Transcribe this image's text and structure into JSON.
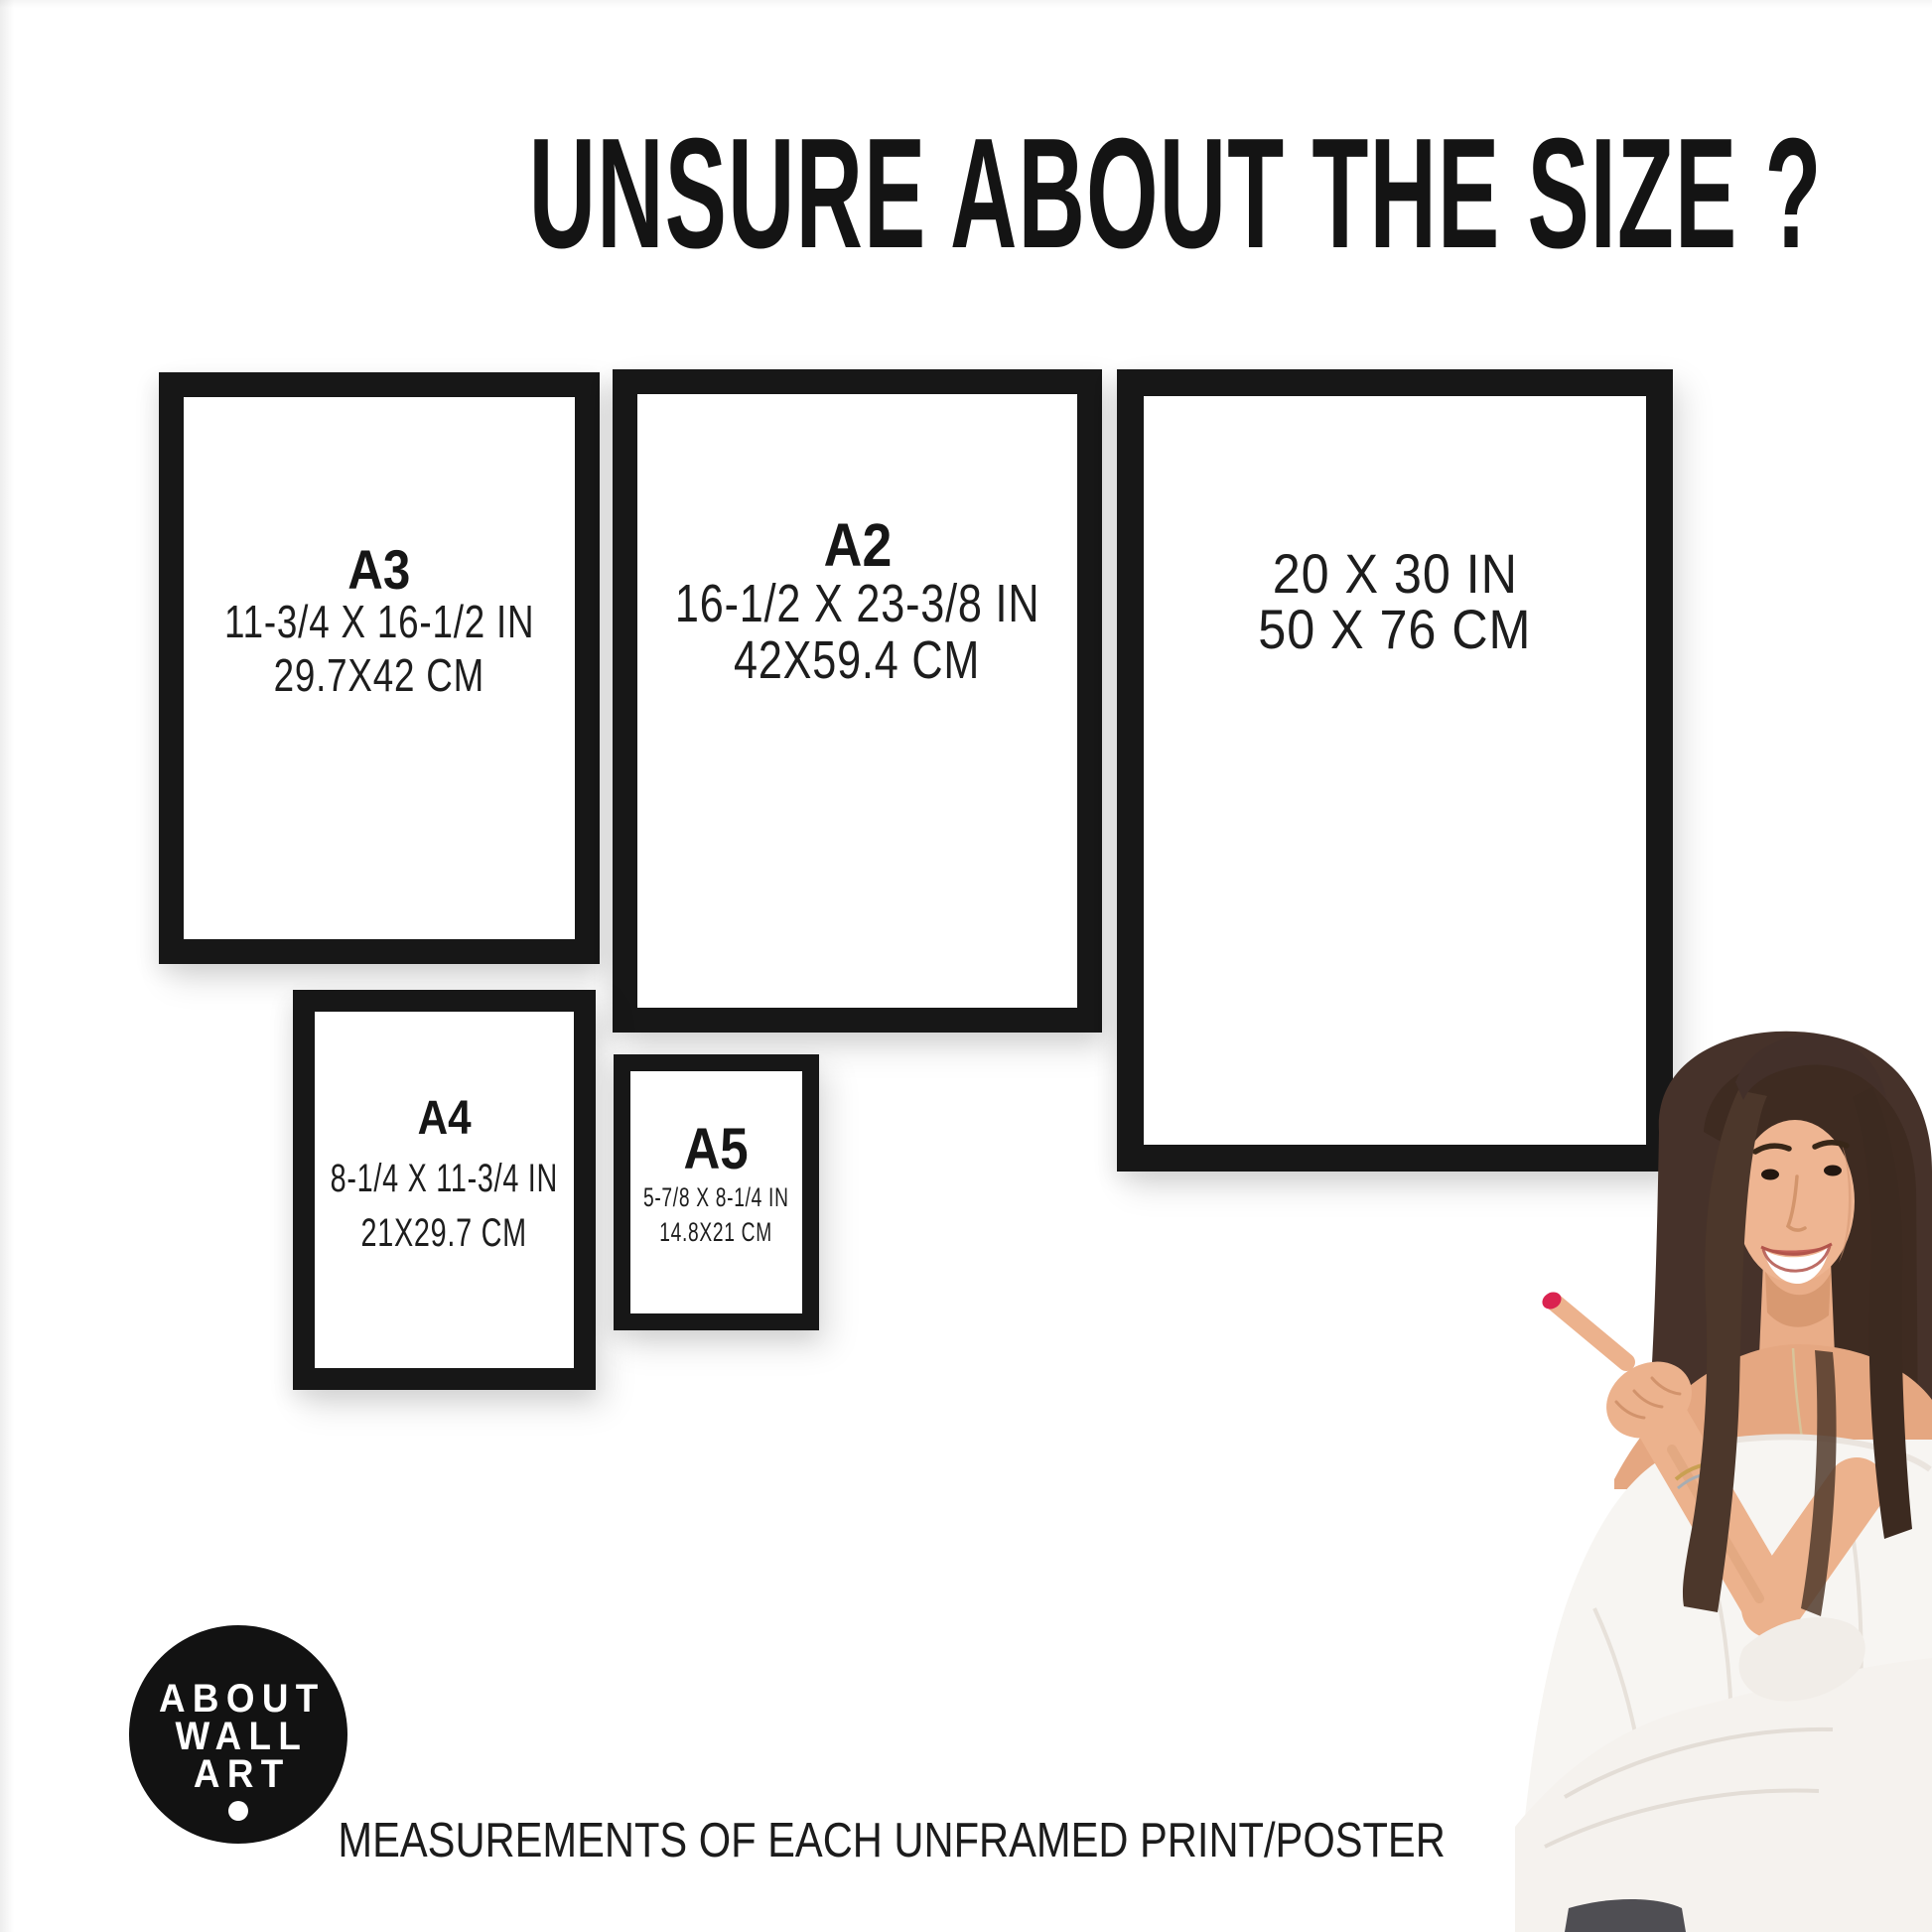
{
  "title": "UNSURE ABOUT THE SIZE ?",
  "frames": [
    {
      "id": "A3",
      "label": "A3",
      "inches": "11-3/4 X 16-1/2 IN",
      "cm": "29.7X42 CM"
    },
    {
      "id": "A2",
      "label": "A2",
      "inches": "16-1/2 X 23-3/8 IN",
      "cm": "42X59.4 CM"
    },
    {
      "id": "20X30",
      "label": "",
      "inches": "20 X 30 IN",
      "cm": "50 X 76 CM"
    },
    {
      "id": "A4",
      "label": "A4",
      "inches": "8-1/4 X 11-3/4 IN",
      "cm": "21X29.7 CM"
    },
    {
      "id": "A5",
      "label": "A5",
      "inches": "5-7/8 X 8-1/4 IN",
      "cm": "14.8X21 CM"
    }
  ],
  "logo": {
    "lines": [
      "ABOUT",
      "WALL",
      "ART"
    ]
  },
  "footer": "MEASUREMENTS OF EACH UNFRAMED PRINT/POSTER",
  "colors": {
    "frame_border": "#171717",
    "text": "#1c1c1c",
    "logo_background": "#121212",
    "nail_polish": "#da2350",
    "hair": "#46322a",
    "skin": "#ecb28d",
    "blouse": "#f7f5f2"
  }
}
